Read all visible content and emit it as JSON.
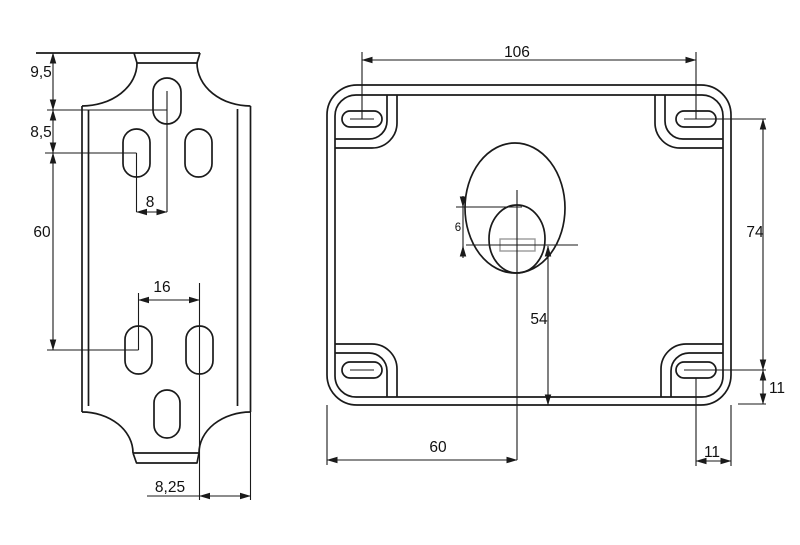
{
  "drawing": {
    "kind": "technical-drawing-two-views",
    "units": "mm",
    "colors": {
      "line": "#1a1a1a",
      "detail_line": "#999999",
      "background": "#ffffff"
    },
    "left_view": {
      "name": "bracket-side-view",
      "dims": {
        "top_to_first_slot": "9,5",
        "first_to_second_slot": "8,5",
        "slot_row_spacing": "60",
        "slot_center_offset": "8",
        "slot_pair_spacing": "16",
        "slot_to_edge": "8,25"
      }
    },
    "right_view": {
      "name": "cover-plate-face-view",
      "dims": {
        "slot_span_horizontal": "106",
        "slot_span_vertical": "74",
        "center_to_bottom": "54",
        "center_from_left": "60",
        "slot_to_bottom_edge": "11",
        "slot_to_right_edge": "11",
        "boss_offset": "6"
      }
    }
  }
}
